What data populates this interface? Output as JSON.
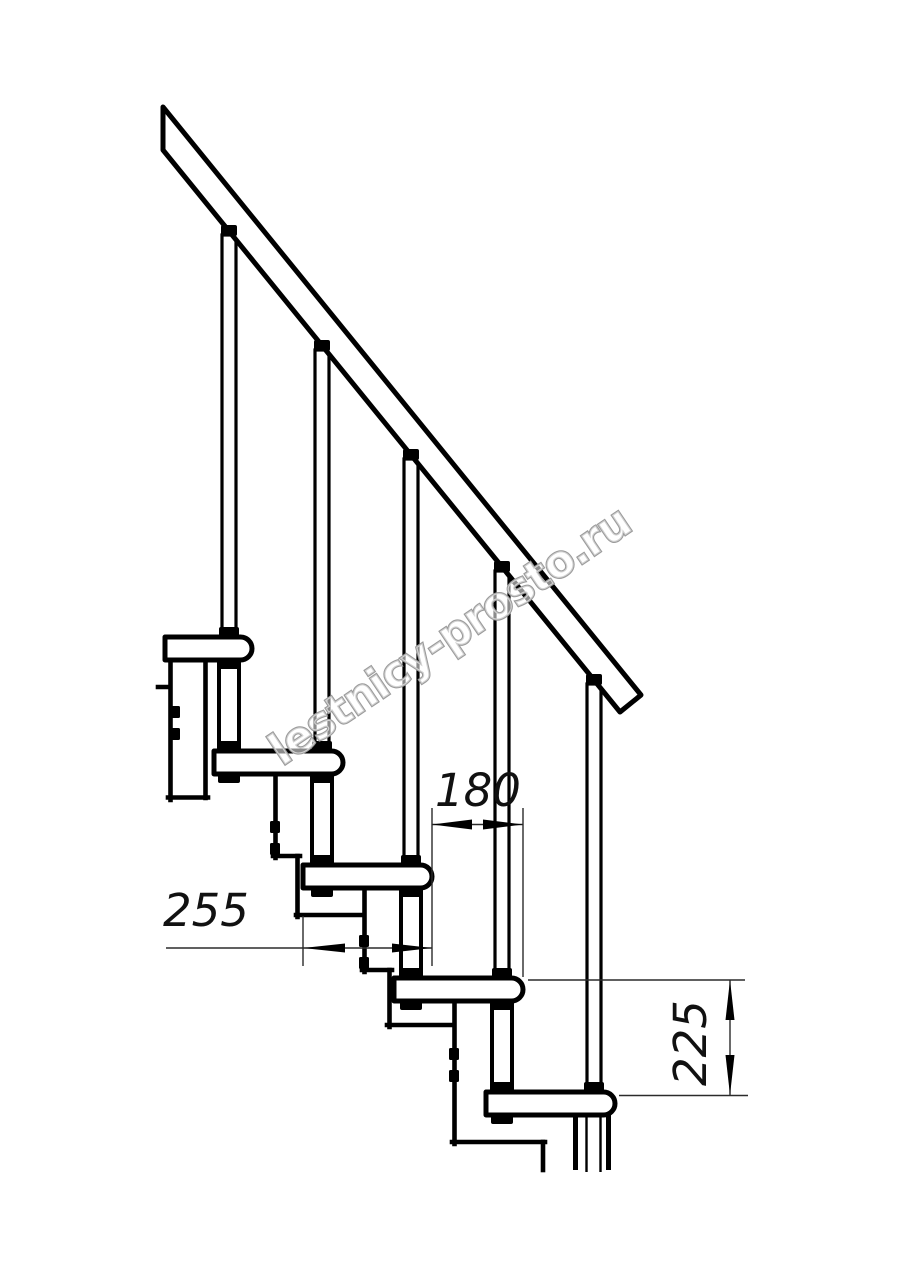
{
  "drawing": {
    "type": "staircase-side-elevation",
    "units_note": "mm",
    "line_color": "#000000",
    "thin_line_color": "#2b2b2b",
    "background": "#ffffff"
  },
  "dimensions": {
    "going": {
      "value": "180",
      "orientation": "horizontal"
    },
    "depth": {
      "value": "255",
      "orientation": "horizontal"
    },
    "rise": {
      "value": "225",
      "orientation": "vertical"
    }
  },
  "watermark": {
    "text": "lestnicy-prosto.ru",
    "color": "#9b9b9b"
  }
}
